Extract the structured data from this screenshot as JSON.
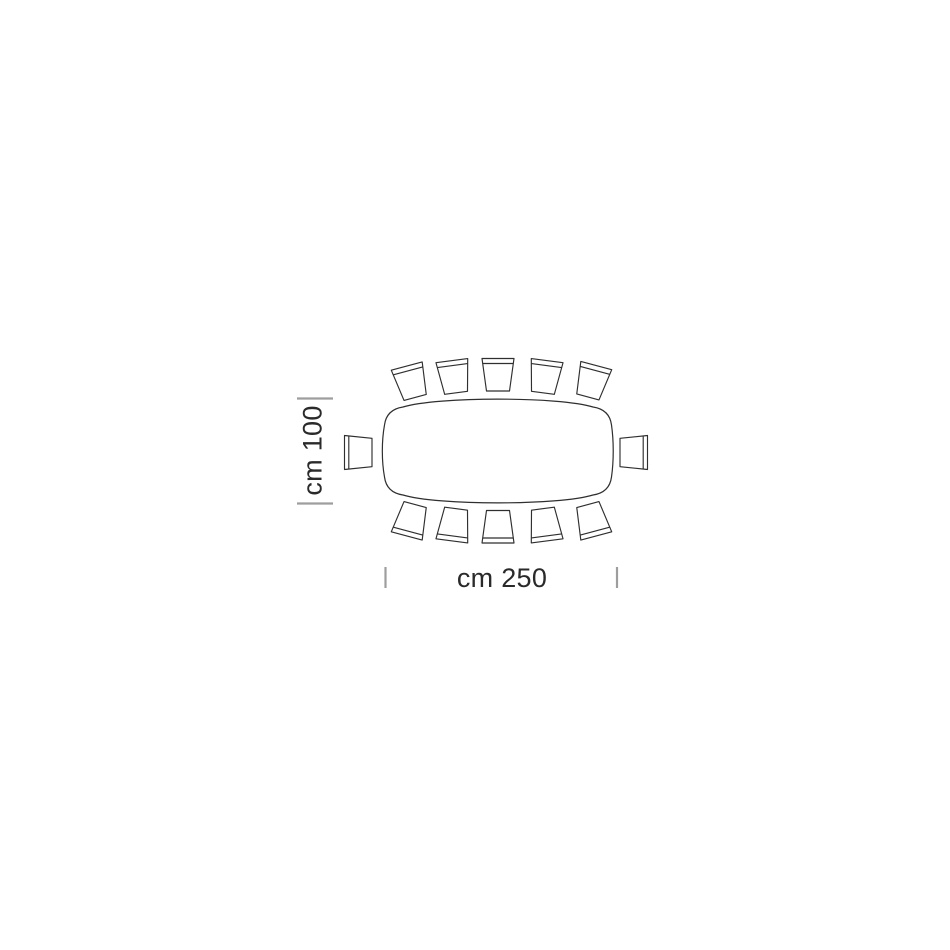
{
  "diagram": {
    "type": "furniture-dimension-drawing",
    "subject": "rectangular barrel-shaped dining table, top view, 12 seats",
    "labels": {
      "width": "cm 100",
      "length": "cm 250"
    },
    "dimensions_cm": {
      "width": 100,
      "length": 250
    },
    "seats": {
      "top_row": 5,
      "bottom_row": 5,
      "left_end": 1,
      "right_end": 1,
      "total": 12
    },
    "colors": {
      "background": "#ffffff",
      "outline": "#2f2f2f",
      "tick": "#9e9e9e",
      "label": "#2a2a2a"
    },
    "chairs": [
      {
        "id": "top-1",
        "kind": "top",
        "x": 411,
        "y": 382,
        "rot": -15
      },
      {
        "id": "top-2",
        "kind": "top",
        "x": 454,
        "y": 377,
        "rot": -7.5
      },
      {
        "id": "top-3",
        "kind": "top",
        "x": 498,
        "y": 375,
        "rot": 0
      },
      {
        "id": "top-4",
        "kind": "top",
        "x": 545,
        "y": 377,
        "rot": 7.5
      },
      {
        "id": "top-5",
        "kind": "top",
        "x": 592,
        "y": 381.5,
        "rot": 15
      },
      {
        "id": "left-end",
        "kind": "left",
        "x": 358.5,
        "y": 452.5,
        "rot": 0
      },
      {
        "id": "right-end",
        "kind": "right",
        "x": 633.5,
        "y": 452.5,
        "rot": 0
      },
      {
        "id": "bottom-1",
        "kind": "bottom",
        "x": 411,
        "y": 520,
        "rot": 15
      },
      {
        "id": "bottom-2",
        "kind": "bottom",
        "x": 454,
        "y": 524.5,
        "rot": 7.5
      },
      {
        "id": "bottom-3",
        "kind": "bottom",
        "x": 498,
        "y": 526.5,
        "rot": 0
      },
      {
        "id": "bottom-4",
        "kind": "bottom",
        "x": 545,
        "y": 524.5,
        "rot": -7.5
      },
      {
        "id": "bottom-5",
        "kind": "bottom",
        "x": 592,
        "y": 520,
        "rot": -15
      }
    ]
  }
}
